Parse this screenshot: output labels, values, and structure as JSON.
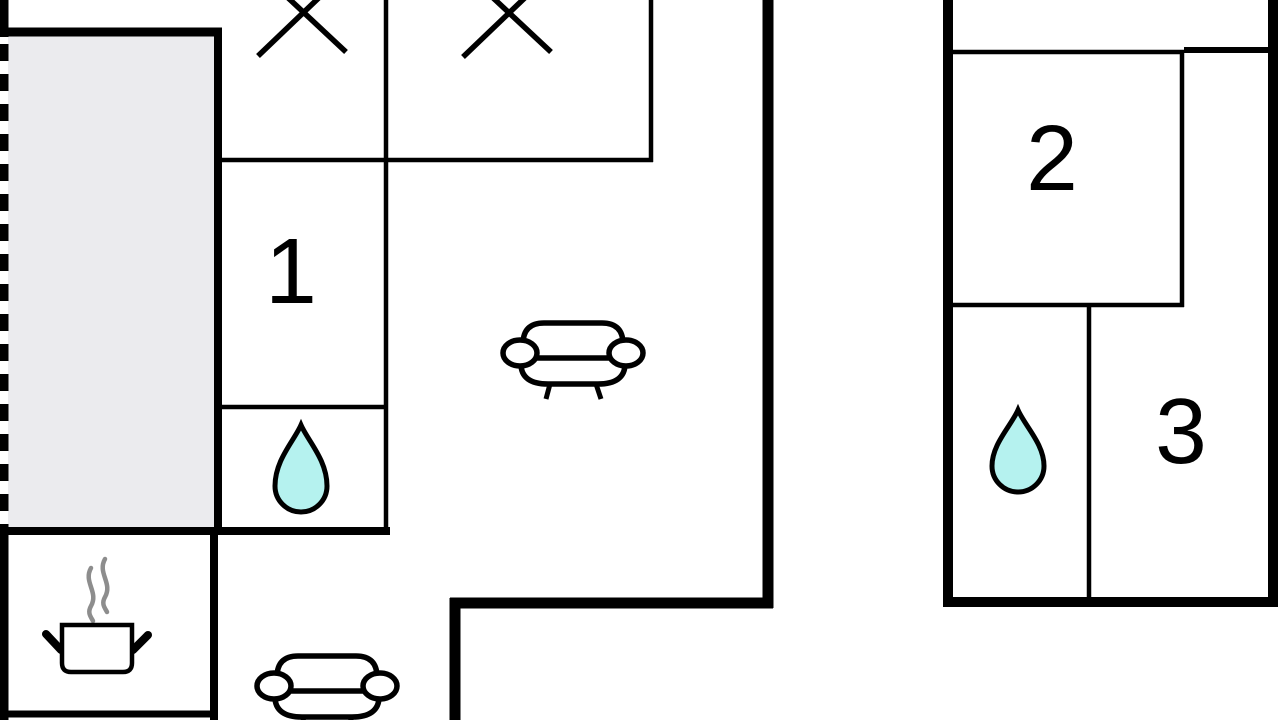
{
  "colors": {
    "background": "#ffffff",
    "wall": "#000000",
    "terrace_fill": "#ebebee",
    "water_drop_fill": "#b5f2ef",
    "steam_stroke": "#8d8d8d"
  },
  "rooms": [
    {
      "label": "1"
    },
    {
      "label": "2"
    },
    {
      "label": "3"
    }
  ],
  "icons": [
    "x-marker-icon",
    "x-marker-icon",
    "sofa-icon",
    "sofa-icon",
    "water-drop-icon",
    "water-drop-icon",
    "cooking-pot-icon",
    "steam-icon"
  ]
}
